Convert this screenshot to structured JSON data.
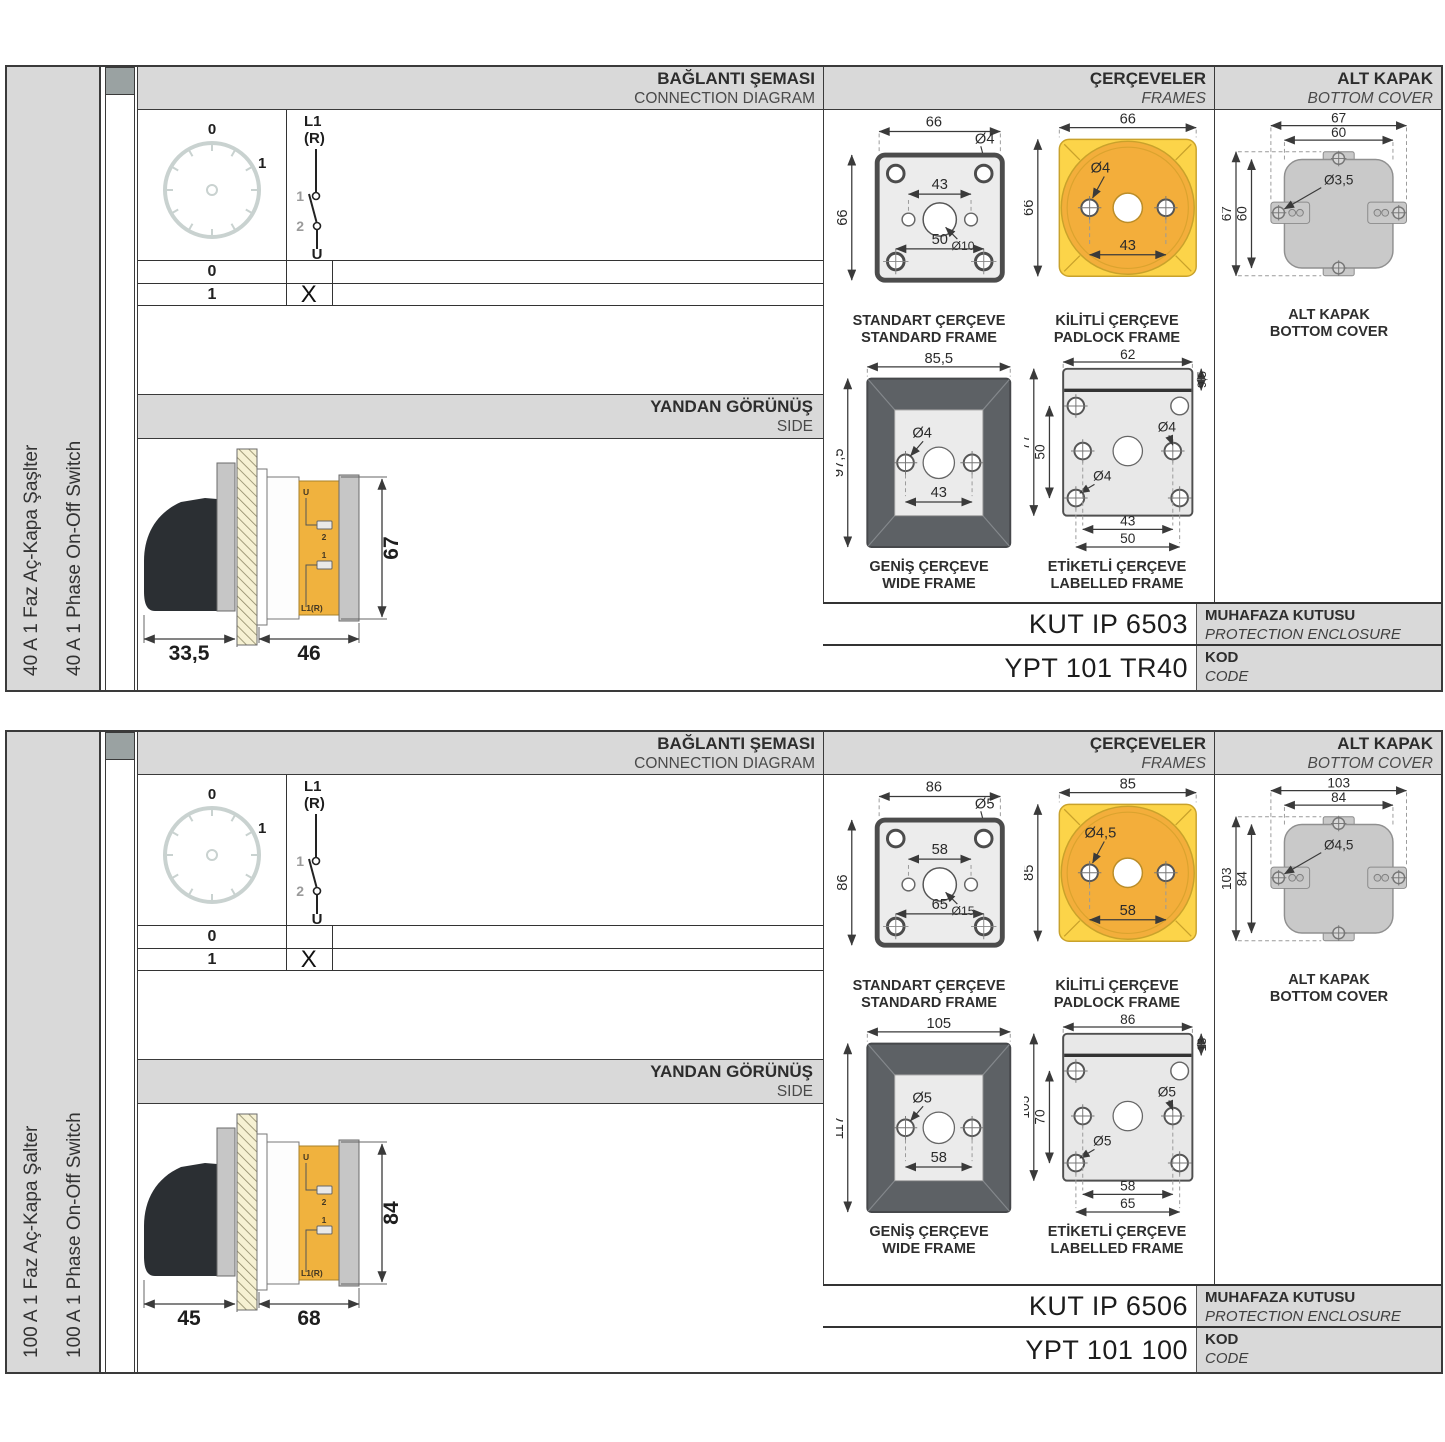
{
  "colors": {
    "header_gray": "#d9d9d9",
    "accent_yellow": "#fcd449",
    "accent_orange": "#f3ae3b",
    "drawing_gray": "#ececec",
    "dark_frame_gray": "#5d6165",
    "cover_gray": "#c9c9c9",
    "terminal_yellow": "#f0b23e"
  },
  "panels": [
    {
      "side_label_tr": "40 A 1 Faz Aç-Kapa Şaşlter",
      "side_label_en": "40 A 1 Phase On-Off Switch",
      "headers": {
        "connection_tr": "BAĞLANTI ŞEMASI",
        "connection_en": "CONNECTION DIAGRAM",
        "frames_tr": "ÇERÇEVELER",
        "frames_en": "FRAMES",
        "cover_tr": "ALT KAPAK",
        "cover_en": "BOTTOM COVER",
        "side_tr": "YANDAN GÖRÜNÜŞ",
        "side_en": "SIDE"
      },
      "diagram": {
        "dial_top": "0",
        "dial_right": "1",
        "line_in": "L1",
        "line_in2": "(R)",
        "contact_a": "1",
        "contact_b": "2",
        "line_out": "U",
        "rows": [
          {
            "pos": "0",
            "mark": ""
          },
          {
            "pos": "1",
            "mark": "X"
          }
        ]
      },
      "side_view": {
        "dim_left": "33,5",
        "dim_right": "46",
        "dim_height": "67",
        "label_u": "U",
        "label_2": "2",
        "label_1": "1",
        "label_l1r": "L1(R)"
      },
      "frames": {
        "standard": {
          "title_tr": "STANDART ÇERÇEVE",
          "title_en": "STANDARD FRAME",
          "dim_w": "66",
          "dim_h": "66",
          "dim_hole": "Ø4",
          "dim_inner": "43",
          "dim_center": "Ø10",
          "dim_lower": "50"
        },
        "padlock": {
          "title_tr": "KİLİTLİ ÇERÇEVE",
          "title_en": "PADLOCK FRAME",
          "dim_w": "66",
          "dim_h": "66",
          "dim_hole": "Ø4",
          "dim_inner": "43"
        },
        "wide": {
          "title_tr": "GENİŞ ÇERÇEVE",
          "title_en": "WIDE FRAME",
          "dim_w": "85,5",
          "dim_h": "97,5",
          "dim_hole": "Ø4",
          "dim_inner": "43"
        },
        "labelled": {
          "title_tr": "ETİKETLİ ÇERÇEVE",
          "title_en": "LABELLED FRAME",
          "dim_w": "62",
          "dim_strip": "9,5",
          "dim_h": "77",
          "dim_inner_v": "50",
          "dim_hole_a": "Ø4",
          "dim_hole_b": "Ø4",
          "dim_inner": "43",
          "dim_lower": "50"
        }
      },
      "cover": {
        "title_tr": "ALT KAPAK",
        "title_en": "BOTTOM COVER",
        "dim_w_out": "67",
        "dim_w_in": "60",
        "dim_hole": "Ø3,5",
        "dim_h_out": "67",
        "dim_h_in": "60"
      },
      "codes": {
        "enclosure_value": "KUT IP 6503",
        "enclosure_tr": "MUHAFAZA KUTUSU",
        "enclosure_en": "PROTECTION ENCLOSURE",
        "code_value": "YPT 101 TR40",
        "code_tr": "KOD",
        "code_en": "CODE"
      }
    },
    {
      "side_label_tr": "100 A 1 Faz Aç-Kapa Şalter",
      "side_label_en": "100 A 1 Phase On-Off Switch",
      "headers": {
        "connection_tr": "BAĞLANTI ŞEMASI",
        "connection_en": "CONNECTION DIAGRAM",
        "frames_tr": "ÇERÇEVELER",
        "frames_en": "FRAMES",
        "cover_tr": "ALT KAPAK",
        "cover_en": "BOTTOM COVER",
        "side_tr": "YANDAN GÖRÜNÜŞ",
        "side_en": "SIDE"
      },
      "diagram": {
        "dial_top": "0",
        "dial_right": "1",
        "line_in": "L1",
        "line_in2": "(R)",
        "contact_a": "1",
        "contact_b": "2",
        "line_out": "U",
        "rows": [
          {
            "pos": "0",
            "mark": ""
          },
          {
            "pos": "1",
            "mark": "X"
          }
        ]
      },
      "side_view": {
        "dim_left": "45",
        "dim_right": "68",
        "dim_height": "84",
        "label_u": "U",
        "label_2": "2",
        "label_1": "1",
        "label_l1r": "L1(R)"
      },
      "frames": {
        "standard": {
          "title_tr": "STANDART ÇERÇEVE",
          "title_en": "STANDARD FRAME",
          "dim_w": "86",
          "dim_h": "86",
          "dim_hole": "Ø5",
          "dim_inner": "58",
          "dim_center": "Ø15",
          "dim_lower": "65"
        },
        "padlock": {
          "title_tr": "KİLİTLİ ÇERÇEVE",
          "title_en": "PADLOCK FRAME",
          "dim_w": "85",
          "dim_h": "85",
          "dim_hole": "Ø4,5",
          "dim_inner": "58"
        },
        "wide": {
          "title_tr": "GENİŞ ÇERÇEVE",
          "title_en": "WIDE FRAME",
          "dim_w": "105",
          "dim_h": "117",
          "dim_hole": "Ø5",
          "dim_inner": "58"
        },
        "labelled": {
          "title_tr": "ETİKETLİ ÇERÇEVE",
          "title_en": "LABELLED FRAME",
          "dim_w": "86",
          "dim_strip": "13",
          "dim_h": "105",
          "dim_inner_v": "70",
          "dim_hole_a": "Ø5",
          "dim_hole_b": "Ø5",
          "dim_inner": "58",
          "dim_lower": "65"
        }
      },
      "cover": {
        "title_tr": "ALT KAPAK",
        "title_en": "BOTTOM COVER",
        "dim_w_out": "103",
        "dim_w_in": "84",
        "dim_hole": "Ø4,5",
        "dim_h_out": "103",
        "dim_h_in": "84"
      },
      "codes": {
        "enclosure_value": "KUT IP 6506",
        "enclosure_tr": "MUHAFAZA KUTUSU",
        "enclosure_en": "PROTECTION ENCLOSURE",
        "code_value": "YPT 101 100",
        "code_tr": "KOD",
        "code_en": "CODE"
      }
    }
  ]
}
